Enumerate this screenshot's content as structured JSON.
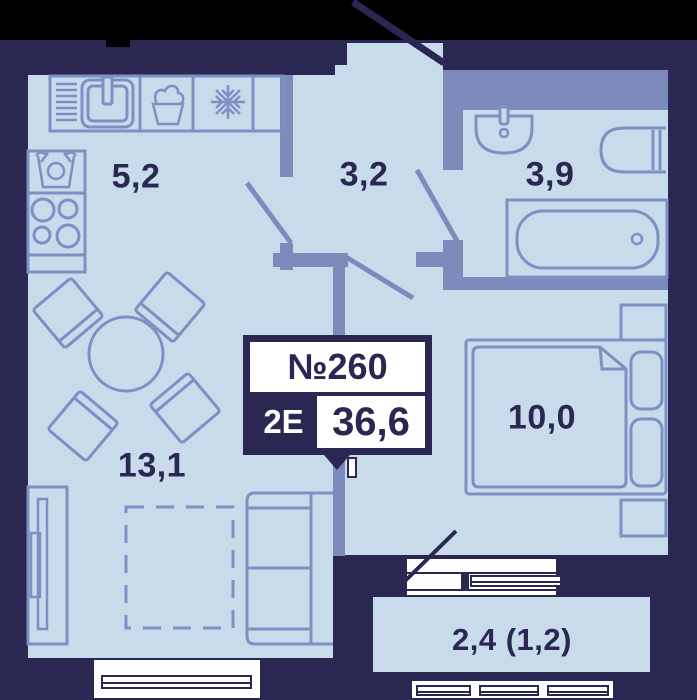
{
  "badge": {
    "number": "№260",
    "type": "2Е",
    "area": "36,6"
  },
  "rooms": {
    "kitchen": "5,2",
    "hallway": "3,2",
    "bathroom": "3,9",
    "living_room": "13,1",
    "bedroom": "10,0",
    "balcony": "2,4 (1,2)"
  },
  "colors": {
    "background": "#000000",
    "wall_outer": "#2a2853",
    "wall_inner": "#7c8bbc",
    "floor": "#c7dbeb",
    "furniture_stroke": "#7c90c4",
    "window_frame": "#ffffff",
    "label_text": "#2a2853",
    "badge_bg": "#2a2853",
    "badge_text_light": "#ffffff"
  },
  "icons": {
    "kitchen": [
      "sink-icon",
      "decor-basket-icon",
      "fridge-snowflake-icon",
      "washing-machine-icon",
      "stove-icon"
    ],
    "bathroom": [
      "washbasin-icon",
      "toilet-icon",
      "bathtub-icon"
    ],
    "living_room": [
      "dining-table",
      "chair",
      "sofa",
      "wardrobe",
      "dashed-layout-area"
    ],
    "bedroom": [
      "double-bed",
      "pillow",
      "nightstand"
    ],
    "openings": [
      "entrance-door-swing",
      "kitchen-door-swing",
      "bathroom-door-swing",
      "bedroom-door-swing",
      "balcony-door-swing"
    ]
  }
}
